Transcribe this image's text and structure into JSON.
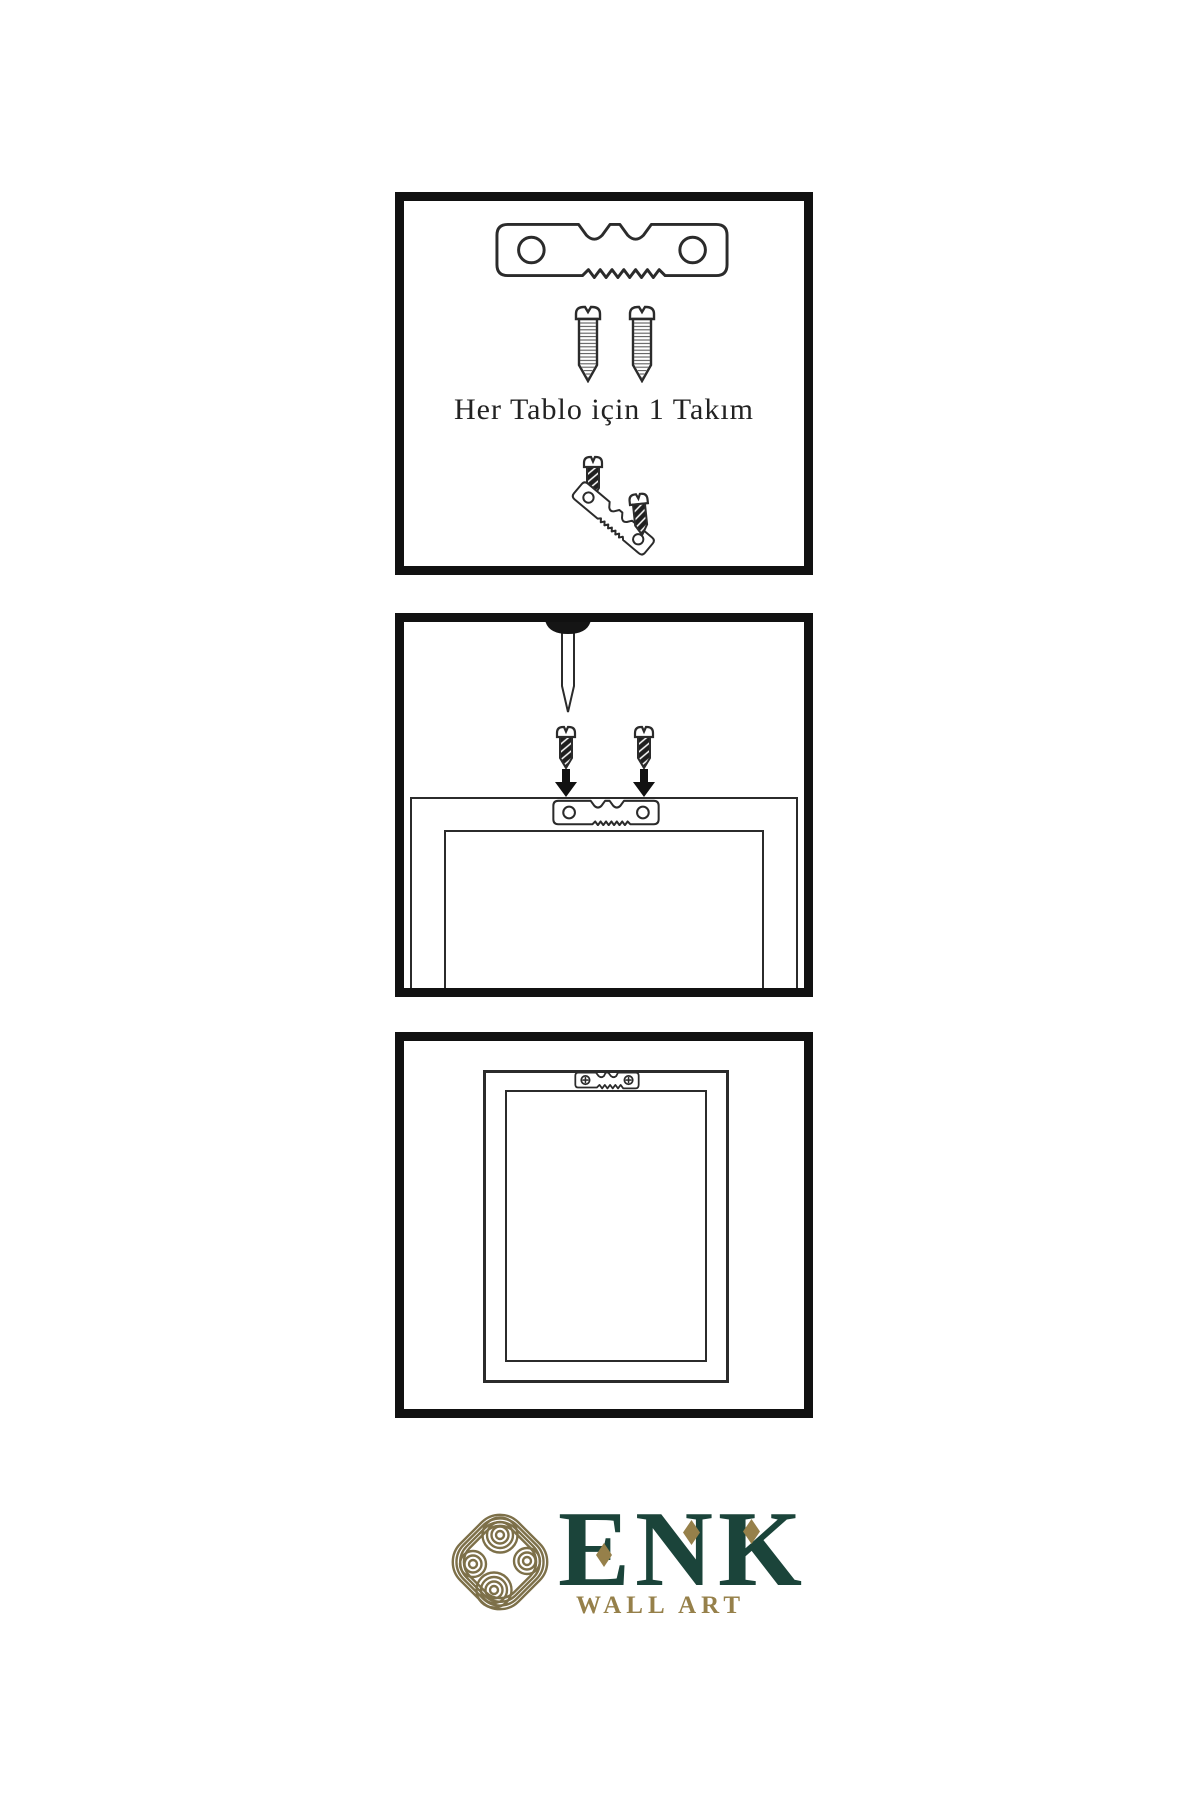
{
  "panels": {
    "kit": {
      "caption": "Her Tablo için 1 Takım",
      "icons": [
        "sawtooth-hanger-icon",
        "screw-icon",
        "screw-icon",
        "dark-screw-icon",
        "tilted-sawtooth-hanger-icon",
        "dark-screw-icon"
      ]
    },
    "mounting": {
      "icons": [
        "nail-icon",
        "dark-screw-icon",
        "dark-screw-icon",
        "arrow-down-icon",
        "arrow-down-icon",
        "frame-icon",
        "sawtooth-hanger-icon"
      ]
    },
    "hanging": {
      "icons": [
        "frame-icon",
        "sawtooth-hanger-mounted-icon"
      ]
    }
  },
  "logo": {
    "brand": "ENK",
    "tagline": "WALL ART",
    "icon": "knot-icon"
  },
  "colors": {
    "line": "#2b2b2b",
    "panel_border": "#111111",
    "brand_green": "#1b443a",
    "brand_gold": "#96804a",
    "knot_gold": "#7d7049",
    "screw_dark": "#1f1f1f",
    "caption_ink": "#222222"
  }
}
